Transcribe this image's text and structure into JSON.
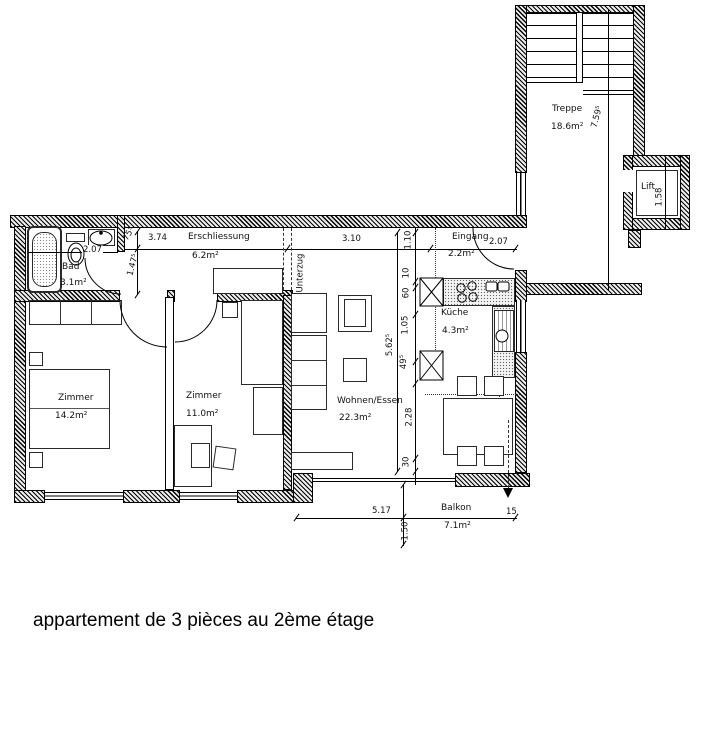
{
  "caption": "appartement de 3 pièces au 2ème étage",
  "rooms": {
    "treppe": {
      "name": "Treppe",
      "area": "18.6m²"
    },
    "lift": {
      "name": "Lift"
    },
    "bad": {
      "name": "Bad",
      "area": "3.1m²"
    },
    "erschliessung": {
      "name": "Erschliessung",
      "area": "6.2m²"
    },
    "eingang": {
      "name": "Eingang",
      "area": "2.2m²"
    },
    "kueche": {
      "name": "Küche",
      "area": "4.3m²"
    },
    "zimmer1": {
      "name": "Zimmer",
      "area": "14.2m²"
    },
    "zimmer2": {
      "name": "Zimmer",
      "area": "11.0m²"
    },
    "wohnen": {
      "name": "Wohnen/Essen",
      "area": "22.3m²"
    },
    "balkon": {
      "name": "Balkon",
      "area": "7.1m²"
    }
  },
  "dimensions": {
    "stair_depth": "7.59⁵",
    "lift_width": "1.58",
    "bad_width": "2.07",
    "hall_wall": "75⁵",
    "hall_width_left": "3.74",
    "hall_depth": "1.47⁵",
    "hall_width_right": "3.10",
    "eingang_width": "2.07",
    "eingang_depth": "1.10",
    "seg_10": "10",
    "seg_60": "60",
    "seg_105": "1.05",
    "seg_495": "49⁵",
    "seg_228": "2.28",
    "seg_30": "30",
    "living_depth": "5.62⁵",
    "balkon_width": "5.17",
    "balkon_depth": "1.50",
    "balkon_edge": "15"
  },
  "annotations": {
    "beam": "Unterzug"
  }
}
